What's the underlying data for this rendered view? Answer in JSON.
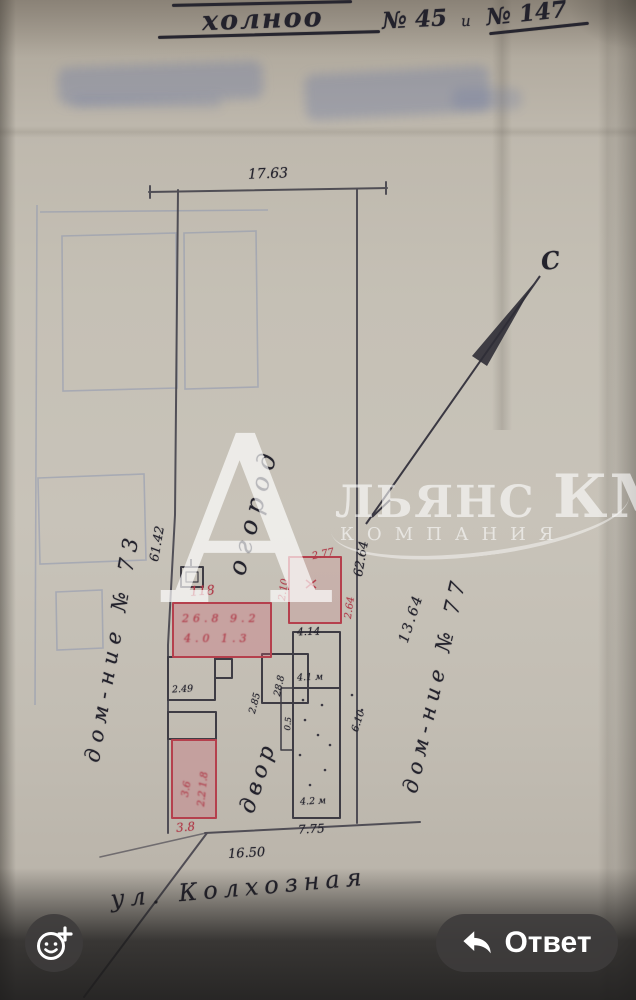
{
  "header": {
    "word": "холноо",
    "number_left": "№ 45",
    "conjunction": "и",
    "number_right": "№ 147"
  },
  "plan": {
    "top_dimension": "17.63",
    "bottom_dimension": "16.50",
    "left_side_dimension": "61.42",
    "right_side_dimension": "62.64",
    "diagonal_dimension": "13.64",
    "compass_north": "С",
    "garden_label": "огород",
    "yard_label": "двор",
    "left_parcel_label": "дом-ние № 73",
    "right_parcel_label": "дом-ние № 77",
    "street_label": "ул. Колхозная",
    "dim_side_38": "3.8",
    "dim_side_775": "7.75",
    "red_marks": [
      "118",
      "2.10",
      "2.77",
      "2.64",
      "26.8 9.2",
      "4.0 1.3",
      "3.6",
      "2.2 1.8"
    ],
    "dark_marks": [
      "4.14",
      "2.49",
      "28.8",
      "4.1 м",
      "4.2 м",
      "6.10",
      "2.85",
      "0.5"
    ]
  },
  "watermark": {
    "big_letter": "А",
    "name_rest": "ЛЬЯНС",
    "name_accent": "КМВ",
    "subtitle": "КОМПАНИЯ"
  },
  "footer": {
    "reply_label": "Ответ"
  },
  "colors": {
    "red_ink": "#b5404d",
    "dark_ink": "#2e2d36",
    "faint_blue_pencil": "#8e97b0",
    "paper_mid": "#c3beb3",
    "footer_button": "#3f3d3d"
  }
}
